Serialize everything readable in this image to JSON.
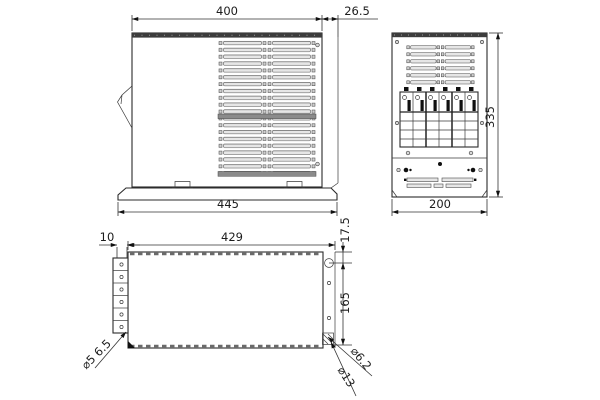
{
  "drawing": {
    "type": "engineering-dimension-drawing",
    "units": "mm",
    "colors": {
      "line": "#2b2b2b",
      "background": "#ffffff",
      "slot_fill": "#e6e6e6",
      "dark_band": "#4a4a4a"
    },
    "views": {
      "top_view": {
        "name": "side elevation with vent grille and mounting base",
        "dimensions": {
          "body_width": "400",
          "rear_overhang": "26.5",
          "base_width": "445"
        }
      },
      "front_view": {
        "name": "front elevation with breaker bank",
        "breaker_modules": 6,
        "dimensions": {
          "height": "335",
          "depth": "200"
        }
      },
      "bottom_view": {
        "name": "bottom view with mounting holes",
        "dimensions": {
          "tab_width": "10",
          "inner_width": "429",
          "hole_offset_top": "17.5",
          "hole_span": "165"
        },
        "callouts": {
          "left_slot_dia": "⌀5 6.5",
          "keyhole_small_dia": "⌀6.2",
          "keyhole_large_dia": "⌀13"
        }
      }
    }
  }
}
